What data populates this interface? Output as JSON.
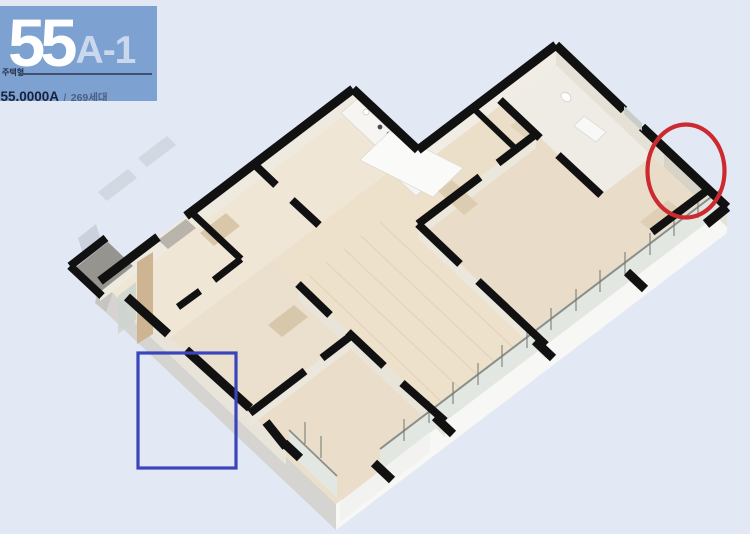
{
  "page": {
    "background_color": "#e2e9f4",
    "description": "Apartment unit isometric floor plan marketing image"
  },
  "label_card": {
    "background_color": "#7da1d1",
    "unit_number": "55",
    "unit_variant": "A-1",
    "type_label": "주택형",
    "area_code": "055.0000A",
    "separator": "/",
    "household_count": "269세대"
  },
  "annotations": {
    "red_ellipse": {
      "color": "#cc2a30",
      "shape": "ellipse",
      "area": "master bedroom upper-right wall corner"
    },
    "blue_rect": {
      "color": "#3a45bd",
      "shape": "rectangle",
      "area": "lower-left outer wall and slab edge"
    }
  },
  "floor_plan": {
    "wall_color": "#111111",
    "floor_color": "#ecdfca",
    "slab_color": "#f7f7f5",
    "railing_glass_color": "#e2e7e3"
  }
}
